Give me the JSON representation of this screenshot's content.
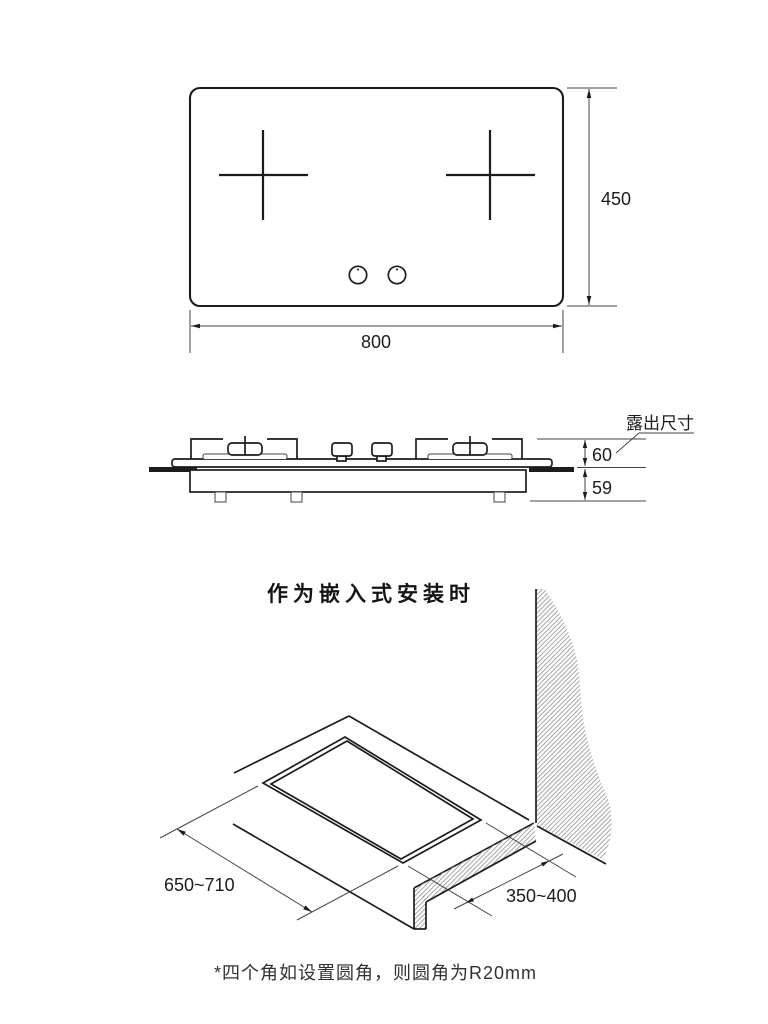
{
  "page": {
    "background": "#ffffff",
    "line_color": "#1c1c1c"
  },
  "top_view": {
    "width_label": "800",
    "height_label": "450"
  },
  "side_view": {
    "callout_label": "露出尺寸",
    "above_counter_label": "60",
    "below_counter_label": "59"
  },
  "built_in_view": {
    "title": "作为嵌入式安装时",
    "cutout_length_label": "650~710",
    "cutout_depth_label": "350~400"
  },
  "footnote": {
    "text": "*四个角如设置圆角，则圆角为R20mm"
  }
}
